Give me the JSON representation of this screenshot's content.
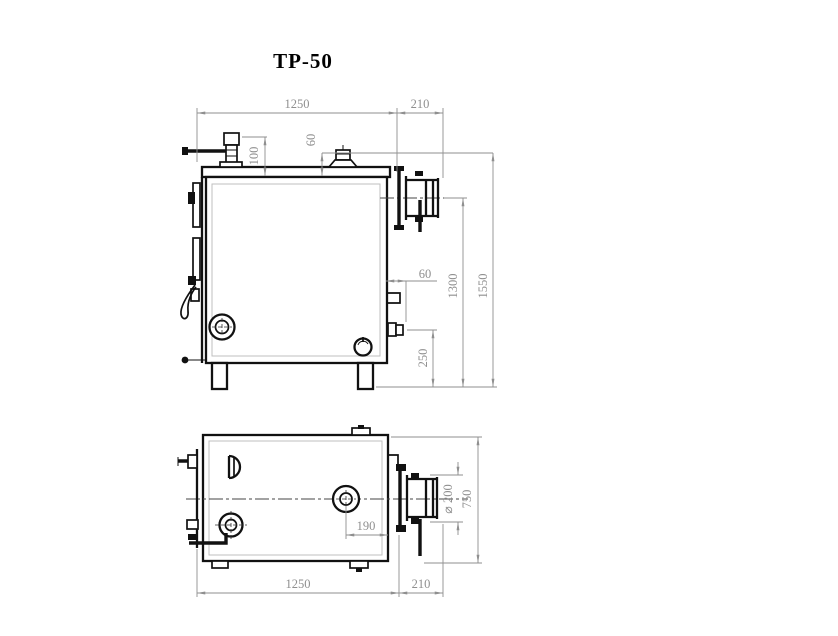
{
  "title": "ТР-50",
  "colors": {
    "line": "#111111",
    "dimension": "#8f8f8f",
    "background": "#ffffff"
  },
  "front_view": {
    "label": "front-elevation",
    "dims": {
      "body_width": "1250",
      "flue_length": "210",
      "valve_height": "100",
      "cap_height": "60",
      "drain_offset": "60",
      "flue_axis_height": "1300",
      "overall_height": "1550",
      "drain_height": "250"
    }
  },
  "plan_view": {
    "label": "plan",
    "dims": {
      "cap_to_edge": "190",
      "flue_diameter": "⌀ 200",
      "body_depth": "750",
      "body_width": "1250",
      "flue_length": "210"
    }
  }
}
